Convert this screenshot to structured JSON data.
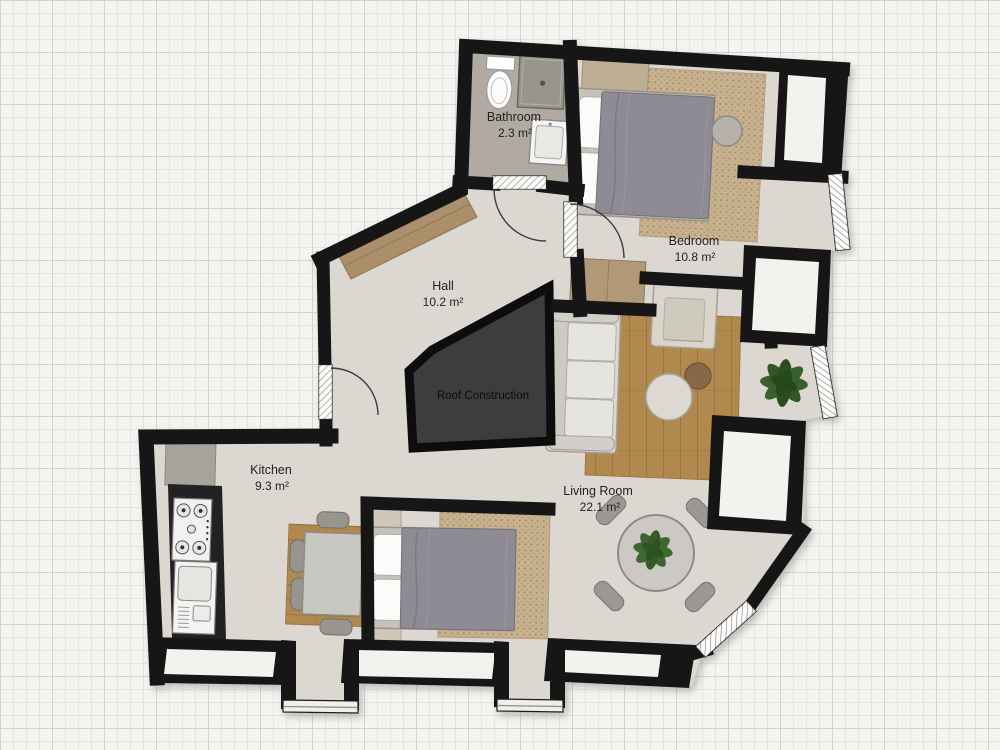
{
  "plan": {
    "rooms": [
      {
        "id": "bathroom",
        "name": "Bathroom",
        "area": "2.3 m²",
        "furniture": [
          "toilet",
          "shower",
          "sink"
        ]
      },
      {
        "id": "bedroom",
        "name": "Bedroom",
        "area": "10.8 m²",
        "furniture": [
          "double-bed",
          "rug",
          "pouf",
          "bench",
          "sideboard"
        ]
      },
      {
        "id": "hall",
        "name": "Hall",
        "area": "10.2 m²",
        "furniture": [
          "wardrobe"
        ]
      },
      {
        "id": "kitchen",
        "name": "Kitchen",
        "area": "9.3 m²",
        "furniture": [
          "counter",
          "stove",
          "sink-unit",
          "dining-table",
          "chairs"
        ]
      },
      {
        "id": "living_room",
        "name": "Living Room",
        "area": "22.1 m²",
        "furniture": [
          "sofa",
          "armchair",
          "coffee-table",
          "side-table",
          "wood-rug",
          "round-table",
          "chairs",
          "plant",
          "double-bed",
          "nightstands",
          "rug"
        ]
      }
    ],
    "annotations": {
      "roof_label": "Roof Construction"
    },
    "colors": {
      "wall": "#161616",
      "floor": "#dcd8d1",
      "bathroom_floor": "#b1aaa2",
      "roof_fill": "#3d3d3d",
      "window_niche": "#f3f2ef",
      "wood_furniture": "#aa8f6b",
      "wood_rug": "#b1894f",
      "tan_rug": "#c7b18e",
      "duvet": "#8e8b94",
      "plant": "#3c6330",
      "grid_line": "#dfe3df",
      "paper": "#f4f4f1"
    }
  }
}
